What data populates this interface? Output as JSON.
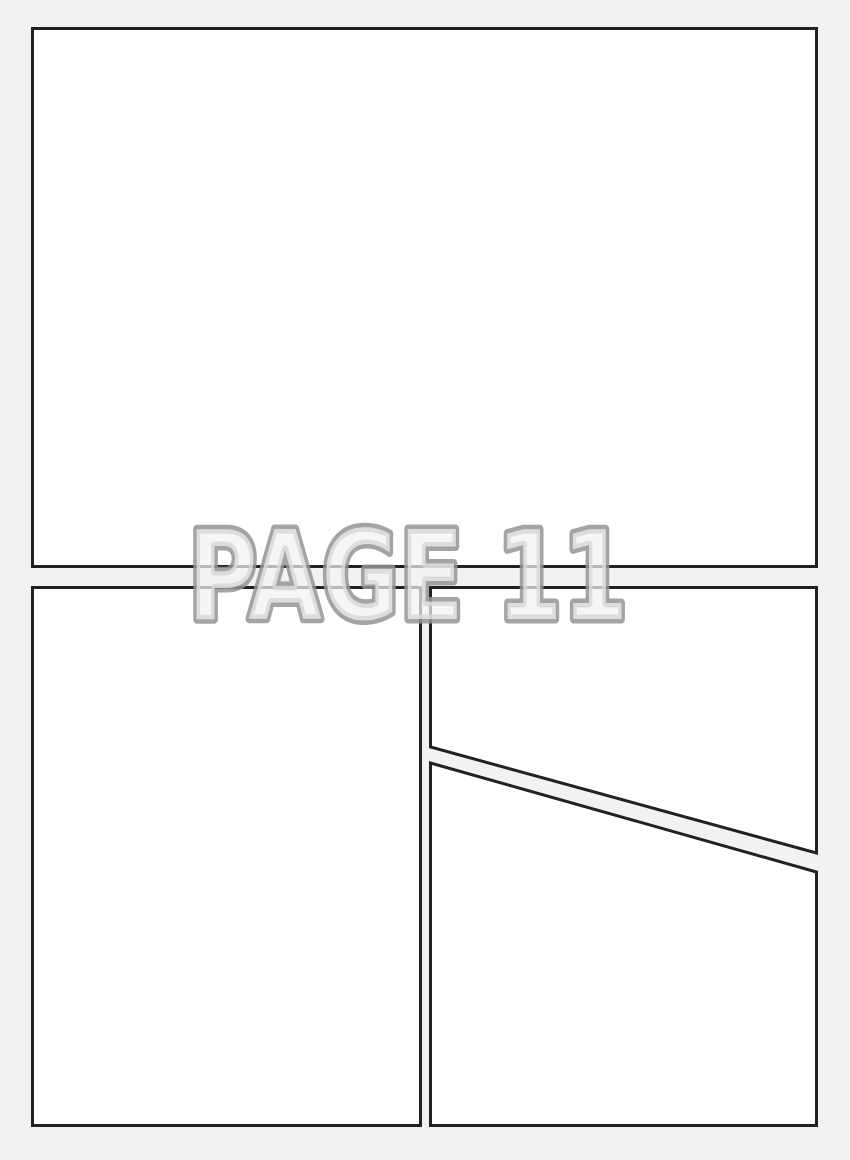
{
  "watermark": {
    "text": "PAGE 11"
  },
  "colors": {
    "page_background": "#f2f2f2",
    "panel_fill": "#ffffff",
    "panel_border": "#212121",
    "watermark_outline": "#949494",
    "watermark_fill": "#f3f3f3"
  },
  "panels": [
    {
      "id": "top",
      "shape": "rectangle"
    },
    {
      "id": "bottom-left",
      "shape": "rectangle"
    },
    {
      "id": "bottom-right-upper",
      "shape": "rectangle-with-diagonal-bottom"
    },
    {
      "id": "bottom-right-lower",
      "shape": "rectangle-with-diagonal-top"
    }
  ]
}
